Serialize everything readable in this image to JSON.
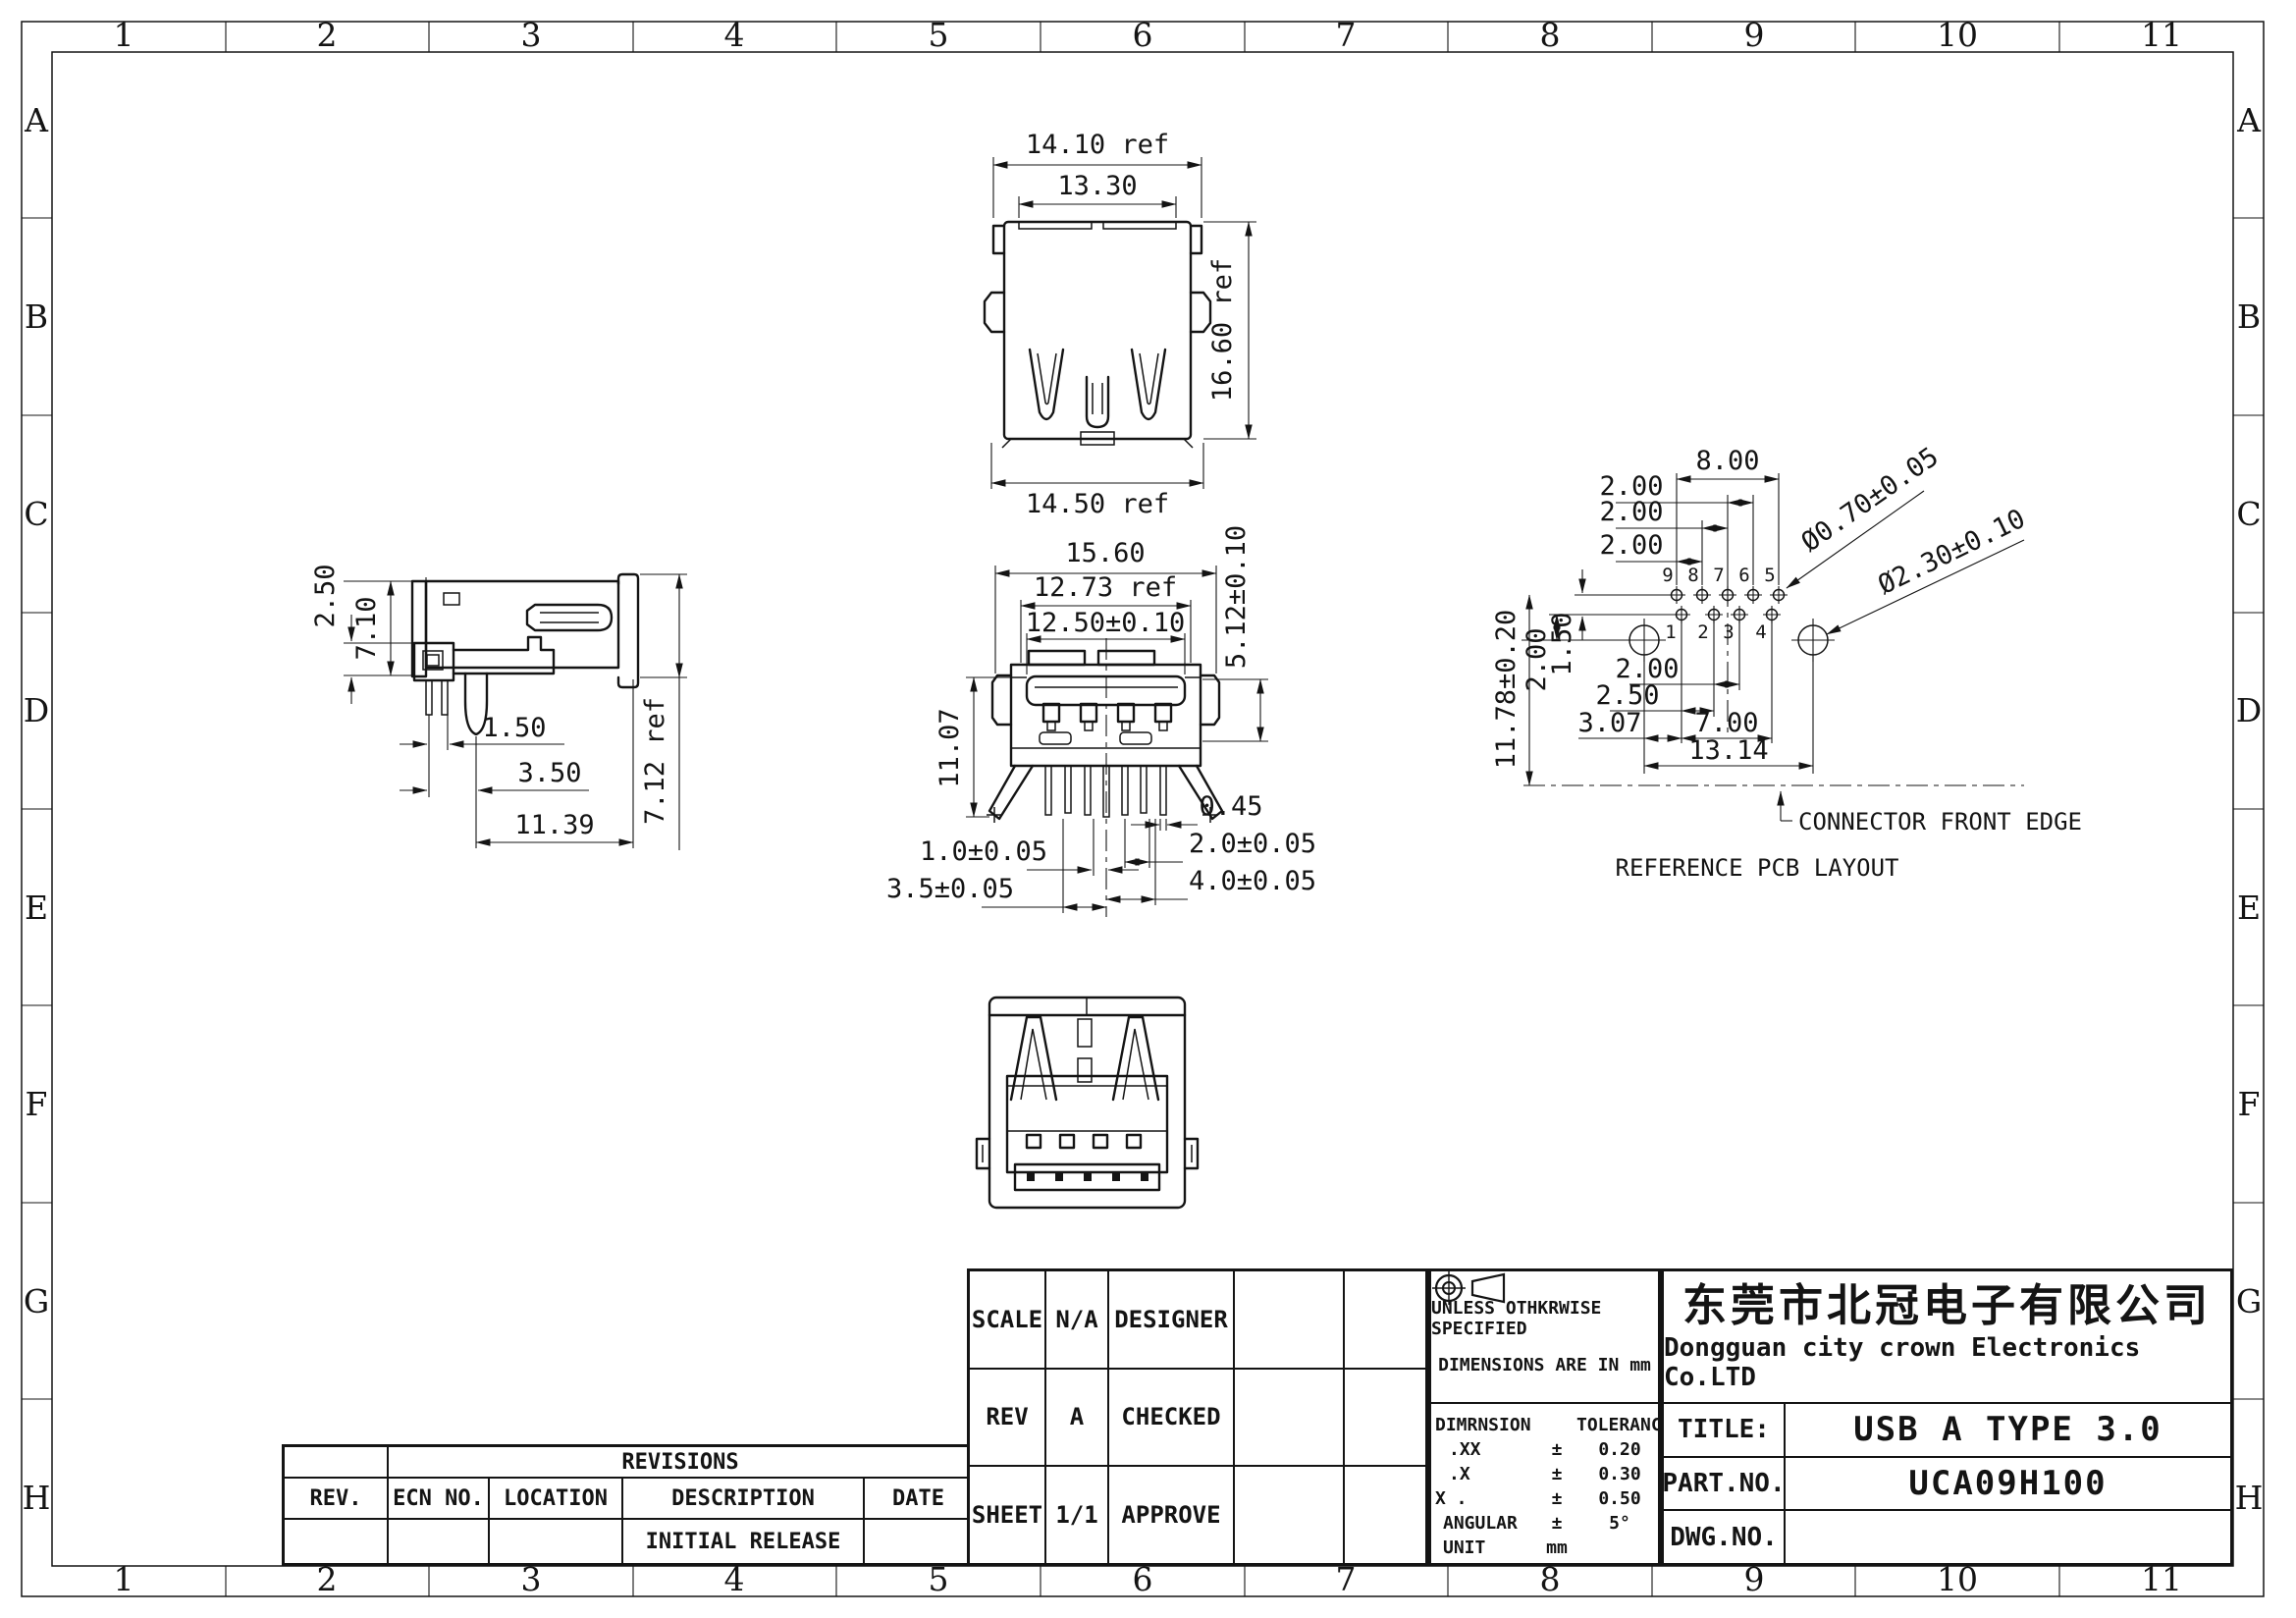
{
  "grid": {
    "cols": [
      "1",
      "2",
      "3",
      "4",
      "5",
      "6",
      "7",
      "8",
      "9",
      "10",
      "11"
    ],
    "rows": [
      "A",
      "B",
      "C",
      "D",
      "E",
      "F",
      "G",
      "H"
    ]
  },
  "views": {
    "rear": {
      "d_width": "14.10 ref",
      "d_inner": "13.30",
      "d_height": "16.60 ref",
      "d_bottom": "14.50 ref"
    },
    "side": {
      "d1": "2.50",
      "d2": "7.10",
      "d3": "1.50",
      "d4": "3.50",
      "d5": "11.39",
      "d6": "7.12 ref"
    },
    "front": {
      "d_overall": "15.60",
      "d_ref": "12.73 ref",
      "d_tongue": "12.50±0.10",
      "d_h1": "5.12±0.10",
      "d_h2": "11.07",
      "d_pin": "0.45",
      "d_p2": "2.0±0.05",
      "d_p1": "1.0±0.05",
      "d_p4": "4.0±0.05",
      "d_p35": "3.5±0.05"
    },
    "pcb": {
      "d_8": "8.00",
      "d_2a": "2.00",
      "d_2b": "2.00",
      "d_2c": "2.00",
      "d_hole_small": "Ø0.70±0.05",
      "d_hole_big": "Ø2.30±0.10",
      "d_150": "1.50",
      "d_200l": "2.00",
      "d_1178": "11.78±0.20",
      "d_200b": "2.00",
      "d_250": "2.50",
      "d_307": "3.07",
      "d_700": "7.00",
      "d_1314": "13.14",
      "pins_top": [
        "9",
        "8",
        "7",
        "6",
        "5"
      ],
      "pins_bottom": [
        "1",
        "2",
        "3",
        "4"
      ],
      "front_edge_label": "CONNECTOR FRONT EDGE",
      "caption": "REFERENCE PCB LAYOUT"
    }
  },
  "revisions": {
    "title": "REVISIONS",
    "headers": [
      "REV.",
      "ECN NO.",
      "LOCATION",
      "DESCRIPTION",
      "DATE"
    ],
    "rows": [
      {
        "rev": "",
        "ecn": "",
        "location": "",
        "description": "INITIAL RELEASE",
        "date": ""
      }
    ]
  },
  "title_block": {
    "scale_label": "SCALE",
    "scale_value": "N/A",
    "designer_label": "DESIGNER",
    "rev_label": "REV",
    "rev_value": "A",
    "checked_label": "CHECKED",
    "sheet_label": "SHEET",
    "sheet_value": "1/1",
    "approve_label": "APPROVE",
    "spec_line1": "UNLESS OTHKRWISE SPECIFIED",
    "spec_line2": "DIMENSIONS ARE IN mm",
    "tol_header_dim": "DIMRNSION",
    "tol_header_tol": "TOLERANCE",
    "tol_rows": [
      {
        "dim": ".XX",
        "pm": "±",
        "tol": "0.20"
      },
      {
        "dim": ".X",
        "pm": "±",
        "tol": "0.30"
      },
      {
        "dim": "X .",
        "pm": "±",
        "tol": "0.50"
      },
      {
        "dim": "ANGULAR",
        "pm": "±",
        "tol": "5°"
      },
      {
        "dim": "UNIT",
        "pm": "mm",
        "tol": ""
      }
    ],
    "company_cn": "东莞市北冠电子有限公司",
    "company_en": "Dongguan city crown Electronics Co.LTD",
    "title_label": "TITLE:",
    "title_value": "USB A TYPE 3.0",
    "part_label": "PART.NO.",
    "part_value": "UCA09H100",
    "dwg_label": "DWG.NO.",
    "dwg_value": ""
  }
}
